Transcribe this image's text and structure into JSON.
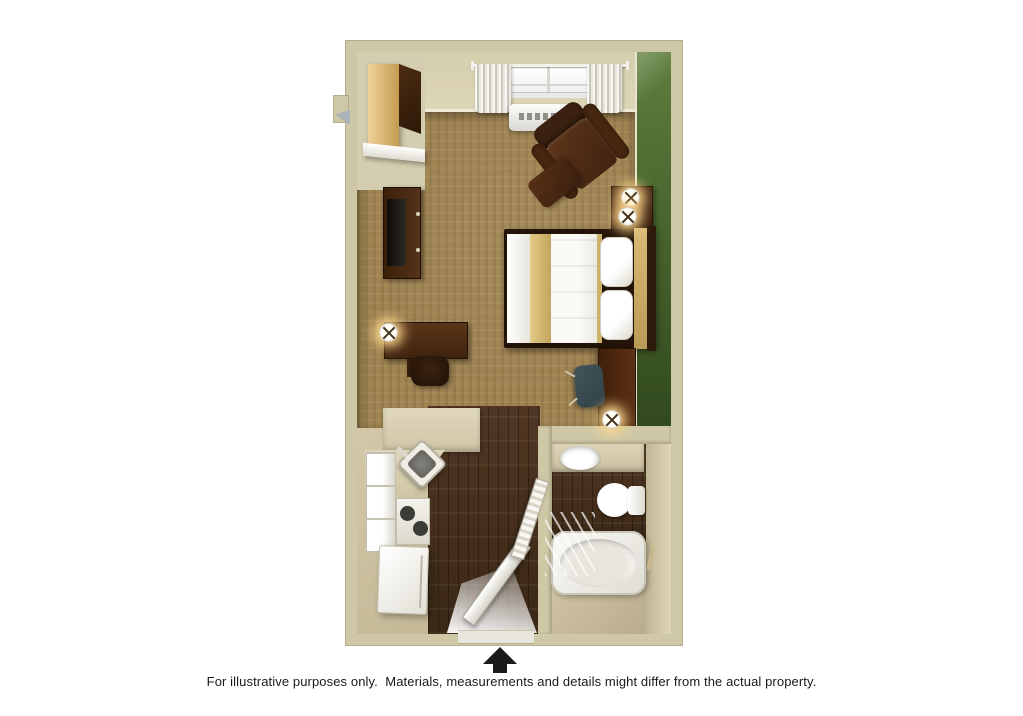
{
  "canvas": {
    "width": 1023,
    "height": 716,
    "background": "#ffffff"
  },
  "footer": {
    "north_arrow": "up-arrow",
    "disclaimer": "For illustrative purposes only.  Materials, measurements and details might differ from the actual property."
  },
  "palette": {
    "wall": "#cfc8a6",
    "wall_face": "#d5cdaf",
    "wall_edge": "#b3ac8e",
    "green_light": "#5d7d3c",
    "green_dark": "#31491d",
    "carpet": "#a08452",
    "wood": "#4a3120",
    "floor_beige": "#d2c7a7",
    "furniture_brown": "#4f2d16",
    "tan_wood": "#d8ba77",
    "white_fixture": "#f6f5f1",
    "tv_black": "#17130f",
    "chair_slate": "#44565c",
    "lamp_glow": "#ffd98e",
    "ink": "#1a1a1a"
  },
  "floorplan": {
    "view": "3d-top-down",
    "unit_type": "studio-suite",
    "rooms": [
      "bedroom-living-area",
      "kitchen",
      "entry-hall",
      "bathroom"
    ],
    "objects": [
      "window-with-curtains",
      "wall-ac-unit",
      "armchair",
      "ottoman",
      "nightstand",
      "table-lamp",
      "queen-bed",
      "headboard",
      "wardrobe-closet",
      "closet-shelf",
      "tv",
      "tv-stand",
      "writing-desk",
      "desk-chair",
      "desk-lamp",
      "work-table",
      "task-chair",
      "kitchen-counter",
      "kitchen-sink",
      "cooktop-stove",
      "refrigerator",
      "kitchen-appliance",
      "entry-door",
      "bathroom-door",
      "vanity-sink",
      "toilet",
      "bathtub",
      "shower-glass",
      "towel-bar",
      "green-accent-wall",
      "north-arrow"
    ]
  }
}
